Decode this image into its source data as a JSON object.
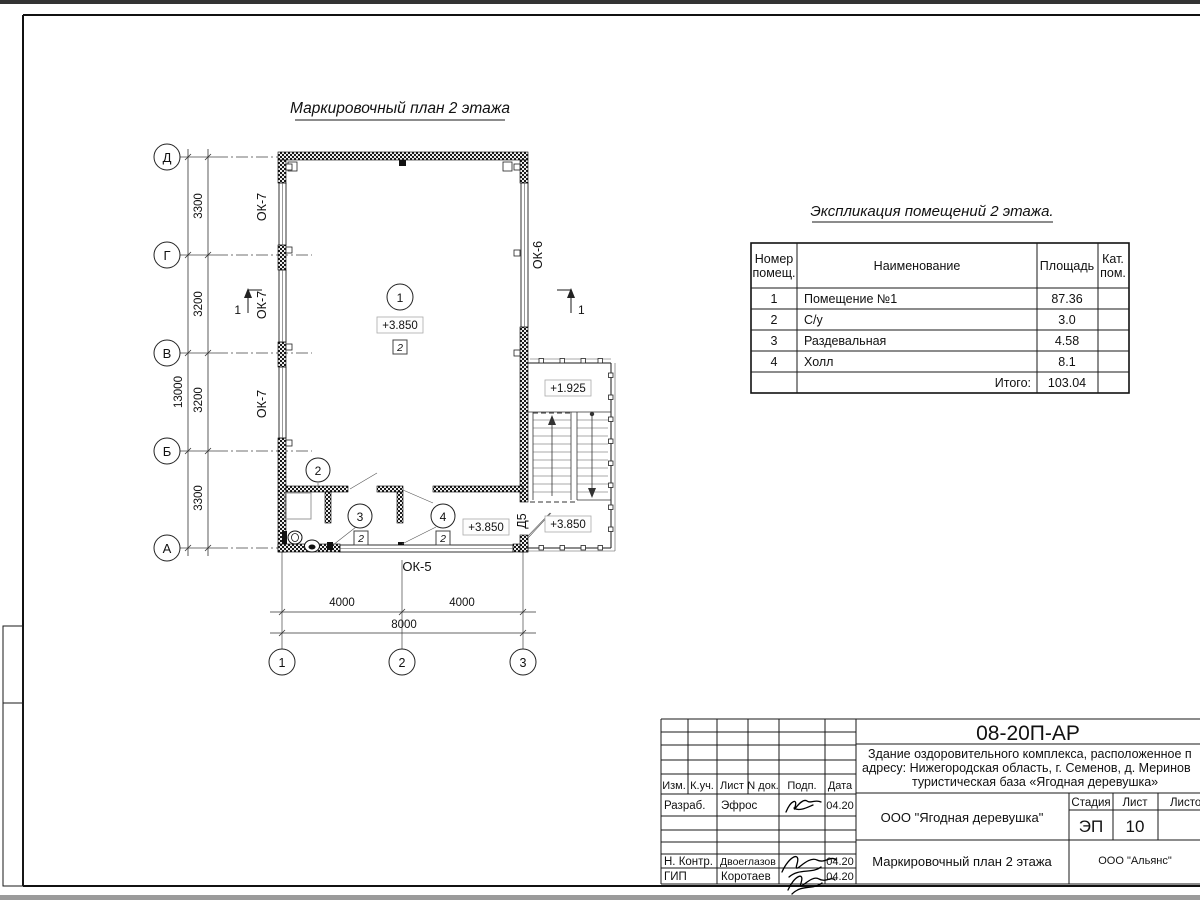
{
  "plan": {
    "title": "Маркировочный план 2 этажа",
    "row_axes": [
      "Д",
      "Г",
      "В",
      "Б",
      "А"
    ],
    "col_axes": [
      "1",
      "2",
      "3"
    ],
    "dims_left": [
      "3300",
      "3200",
      "3200",
      "3300"
    ],
    "dim_left_total": "13000",
    "dims_bottom": [
      "4000",
      "4000"
    ],
    "dim_bottom_total": "8000",
    "window_ok7": "ОК-7",
    "window_ok6": "ОК-6",
    "window_ok5": "ОК-5",
    "door_d5": "Д5",
    "level_room1": "+3.850",
    "level_hall": "+3.850",
    "level_stair_upper": "+1.925",
    "level_stair_lower": "+3.850",
    "tag1": "1",
    "tag2": "2",
    "tag3": "3",
    "tag4": "4",
    "finish_mark": "2",
    "section_label": "1"
  },
  "table": {
    "title": "Экспликация помещений 2 этажа.",
    "headers": {
      "num1": "Номер",
      "num2": "помещ.",
      "name": "Наименование",
      "area": "Площадь",
      "cat1": "Кат.",
      "cat2": "пом."
    },
    "rows": [
      {
        "num": "1",
        "name": "Помещение №1",
        "area": "87.36"
      },
      {
        "num": "2",
        "name": "С/у",
        "area": "3.0"
      },
      {
        "num": "3",
        "name": "Раздевальная",
        "area": "4.58"
      },
      {
        "num": "4",
        "name": "Холл",
        "area": "8.1"
      }
    ],
    "total_label": "Итого:",
    "total_value": "103.04"
  },
  "titleblock": {
    "code": "08-20П-АР",
    "desc_line1": "Здание оздоровительного комплекса, расположенное п",
    "desc_line2": "адресу: Нижегородская область, г. Семенов, д. Меринов",
    "desc_line3": "туристическая база «Ягодная деревушка»",
    "header": {
      "izm": "Изм.",
      "kuch": "К.уч.",
      "list": "Лист",
      "ndok": "N док.",
      "podp": "Подп.",
      "data": "Дата"
    },
    "rows": {
      "razrab_label": "Разраб.",
      "razrab_name": "Эфрос",
      "razrab_date": "04.20",
      "nkontr_label": "Н. Контр.",
      "nkontr_name": "Двоеглазов",
      "nkontr_date": "04.20",
      "gip_label": "ГИП",
      "gip_name": "Коротаев",
      "gip_date": "04.20"
    },
    "org": "ООО \"Ягодная деревушка\"",
    "stage_header": {
      "stage": "Стадия",
      "sheet": "Лист",
      "sheets": "Листо"
    },
    "stage_value": "ЭП",
    "sheet_value": "10",
    "doc_name": "Маркировочный план 2 этажа",
    "firm": "ООО \"Альянс\""
  }
}
